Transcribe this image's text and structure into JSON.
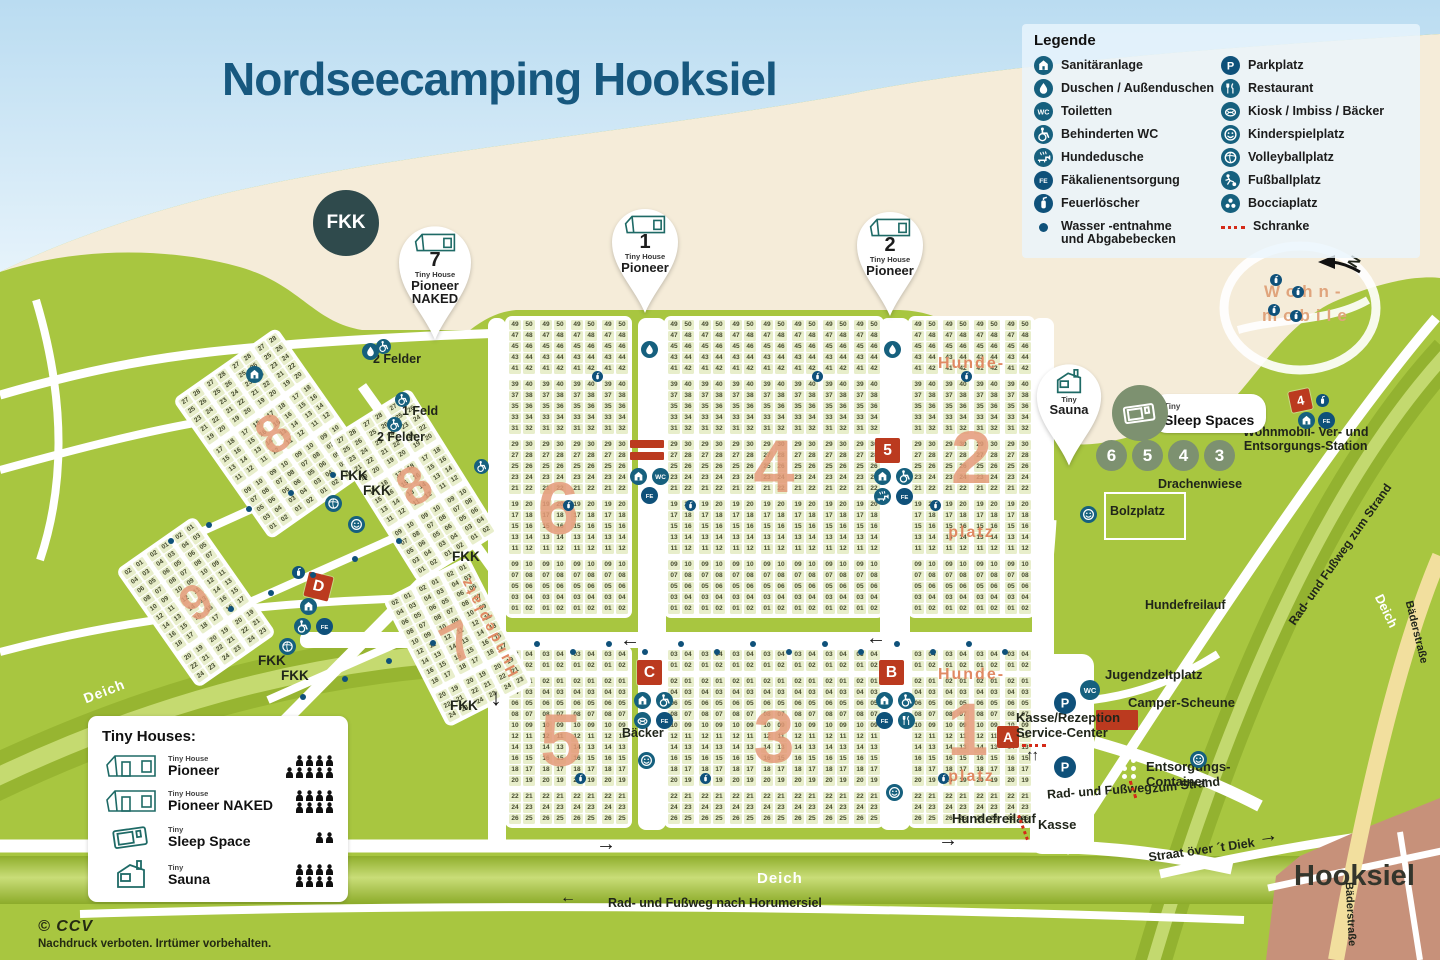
{
  "title": "Nordseecamping Hooksiel",
  "legend": {
    "title": "Legende",
    "left": [
      {
        "icon": "sanitaer",
        "label": "Sanitäranlage"
      },
      {
        "icon": "dusche",
        "label": "Duschen / Außenduschen"
      },
      {
        "icon": "wc",
        "label": "Toiletten"
      },
      {
        "icon": "bwc",
        "label": "Behinderten WC"
      },
      {
        "icon": "hundedusche",
        "label": "Hundedusche"
      },
      {
        "icon": "fe",
        "label": "Fäkalienentsorgung"
      },
      {
        "icon": "feuer",
        "label": "Feuerlöscher"
      },
      {
        "icon": "wasser",
        "label": "Wasser -entnahme\nund Abgabebecken"
      }
    ],
    "right": [
      {
        "icon": "park",
        "label": "Parkplatz"
      },
      {
        "icon": "restaurant",
        "label": "Restaurant"
      },
      {
        "icon": "kiosk",
        "label": "Kiosk / Imbiss / Bäcker"
      },
      {
        "icon": "spielplatz",
        "label": "Kinderspielplatz"
      },
      {
        "icon": "volleyball",
        "label": "Volleyballplatz"
      },
      {
        "icon": "fussball",
        "label": "Fußballplatz"
      },
      {
        "icon": "boccia",
        "label": "Bocciaplatz"
      },
      {
        "icon": "schranke",
        "label": "Schranke"
      }
    ]
  },
  "tiny_houses": {
    "title": "Tiny Houses:",
    "rows": [
      {
        "type": "pioneer",
        "small": "Tiny House",
        "name": "Pioneer",
        "persons": [
          4,
          5
        ]
      },
      {
        "type": "pioneer",
        "small": "Tiny House",
        "name": "Pioneer NAKED",
        "persons": [
          4,
          4
        ]
      },
      {
        "type": "sleep",
        "small": "Tiny",
        "name": "Sleep Space",
        "persons": [
          2
        ]
      },
      {
        "type": "sauna",
        "small": "Tiny",
        "name": "Sauna",
        "persons": [
          4,
          4
        ]
      }
    ]
  },
  "pins": {
    "fkk": "FKK",
    "p7": {
      "num": "7",
      "small": "Tiny House",
      "name": "Pioneer",
      "extra": "NAKED"
    },
    "p1": {
      "num": "1",
      "small": "Tiny House",
      "name": "Pioneer"
    },
    "p2": {
      "num": "2",
      "small": "Tiny House",
      "name": "Pioneer"
    },
    "sauna": {
      "small": "Tiny",
      "name": "Sauna"
    }
  },
  "sleep_spaces": {
    "small": "Tiny",
    "name": "Sleep Spaces",
    "numbers": [
      "6",
      "5",
      "4",
      "3"
    ]
  },
  "buildings": {
    "a": "A",
    "b": "B",
    "c": "C",
    "d": "D",
    "n5": "5",
    "n4": "4"
  },
  "fields": {
    "f1": "1",
    "f2": "2",
    "f3": "3",
    "f4": "4",
    "f5": "5",
    "f6": "6",
    "f7": "7",
    "f8": "8",
    "f9": "9"
  },
  "map": {
    "fkk": "FKK",
    "felder2": "2 Felder",
    "feld1": "1 Feld",
    "baecker": "Bäcker",
    "drachenwiese": "Drachenwiese",
    "bolzplatz": "Bolzplatz",
    "hundefreilauf": "Hundefreilauf",
    "jugend": "Jugendzeltplatz",
    "camper": "Camper-Scheune",
    "kasse_rez": "Kasse/Rezeption\nService-Center",
    "entsorgung": "Entsorgungs-\nContainer",
    "kasse": "Kasse",
    "deich": "Deich",
    "rad_strand": "Rad- und Fußweg zum Strand",
    "rad_strand_a": "Rad- und Fußweg",
    "rad_strand_b": "zum Strand",
    "rad_horum": "Rad- und Fußweg nach Horumersiel",
    "straat": "Straat över ´t Diek",
    "hooksiel": "Hooksiel",
    "baederstrasse": "Bäderstraße",
    "wohn1": "Wohn-",
    "wohn2": "mobile",
    "wohnstation": "Wohnmobil- Ver- und\nEntsorgungs-Station",
    "hunde1": "Hunde-",
    "hunde2": "platz",
    "hundeplatz": "Hundeplatz",
    "north": "N",
    "copyright": "© CCV",
    "notice": "Nachdruck verboten. Irrtümer vorbehalten."
  },
  "sequences": {
    "north": [
      [
        [
          "49",
          "50"
        ],
        [
          "47",
          "48"
        ],
        [
          "45",
          "46"
        ],
        [
          "43",
          "44"
        ],
        [
          "41",
          "42"
        ]
      ],
      [
        [
          "39",
          "40"
        ],
        [
          "37",
          "38"
        ],
        [
          "35",
          "36"
        ],
        [
          "33",
          "34"
        ],
        [
          "31",
          "32"
        ]
      ],
      [
        [
          "29",
          "30"
        ],
        [
          "27",
          "28"
        ],
        [
          "25",
          "26"
        ],
        [
          "23",
          "24"
        ],
        [
          "21",
          "22"
        ]
      ],
      [
        [
          "19",
          "20"
        ],
        [
          "17",
          "18"
        ],
        [
          "15",
          "16"
        ],
        [
          "13",
          "14"
        ],
        [
          "11",
          "12"
        ]
      ],
      [
        [
          "09",
          "10"
        ],
        [
          "07",
          "08"
        ],
        [
          "05",
          "06"
        ],
        [
          "03",
          "04"
        ],
        [
          "01",
          "02"
        ]
      ]
    ],
    "south": [
      [
        [
          "03",
          "04"
        ],
        [
          "01",
          "02"
        ]
      ],
      [
        [
          "02",
          "01"
        ],
        [
          "04",
          "03"
        ],
        [
          "06",
          "05"
        ],
        [
          "08",
          "07"
        ],
        [
          "10",
          "09"
        ],
        [
          "12",
          "11"
        ],
        [
          "14",
          "13"
        ],
        [
          "16",
          "15"
        ],
        [
          "18",
          "17"
        ],
        [
          "20",
          "19"
        ]
      ],
      [
        [
          "22",
          "21"
        ],
        [
          "24",
          "23"
        ],
        [
          "26",
          "25"
        ]
      ]
    ],
    "nw": [
      [
        [
          "27",
          "28"
        ],
        [
          "25",
          "26"
        ],
        [
          "23",
          "24"
        ],
        [
          "21",
          "22"
        ],
        [
          "19",
          "20"
        ]
      ],
      [
        [
          "17",
          "18"
        ],
        [
          "15",
          "16"
        ],
        [
          "13",
          "14"
        ],
        [
          "11",
          "12"
        ]
      ],
      [
        [
          "09",
          "10"
        ],
        [
          "07",
          "08"
        ],
        [
          "05",
          "06"
        ],
        [
          "03",
          "04"
        ],
        [
          "01",
          "02"
        ]
      ]
    ],
    "sw": [
      [
        [
          "02",
          "01"
        ],
        [
          "04",
          "03"
        ],
        [
          "06",
          "05"
        ],
        [
          "08",
          "07"
        ],
        [
          "10",
          "09"
        ],
        [
          "12",
          "11"
        ],
        [
          "14",
          "13"
        ],
        [
          "16",
          "15"
        ],
        [
          "18",
          "17"
        ]
      ],
      [
        [
          "20",
          "19"
        ],
        [
          "22",
          "21"
        ],
        [
          "24",
          "23"
        ]
      ]
    ]
  }
}
